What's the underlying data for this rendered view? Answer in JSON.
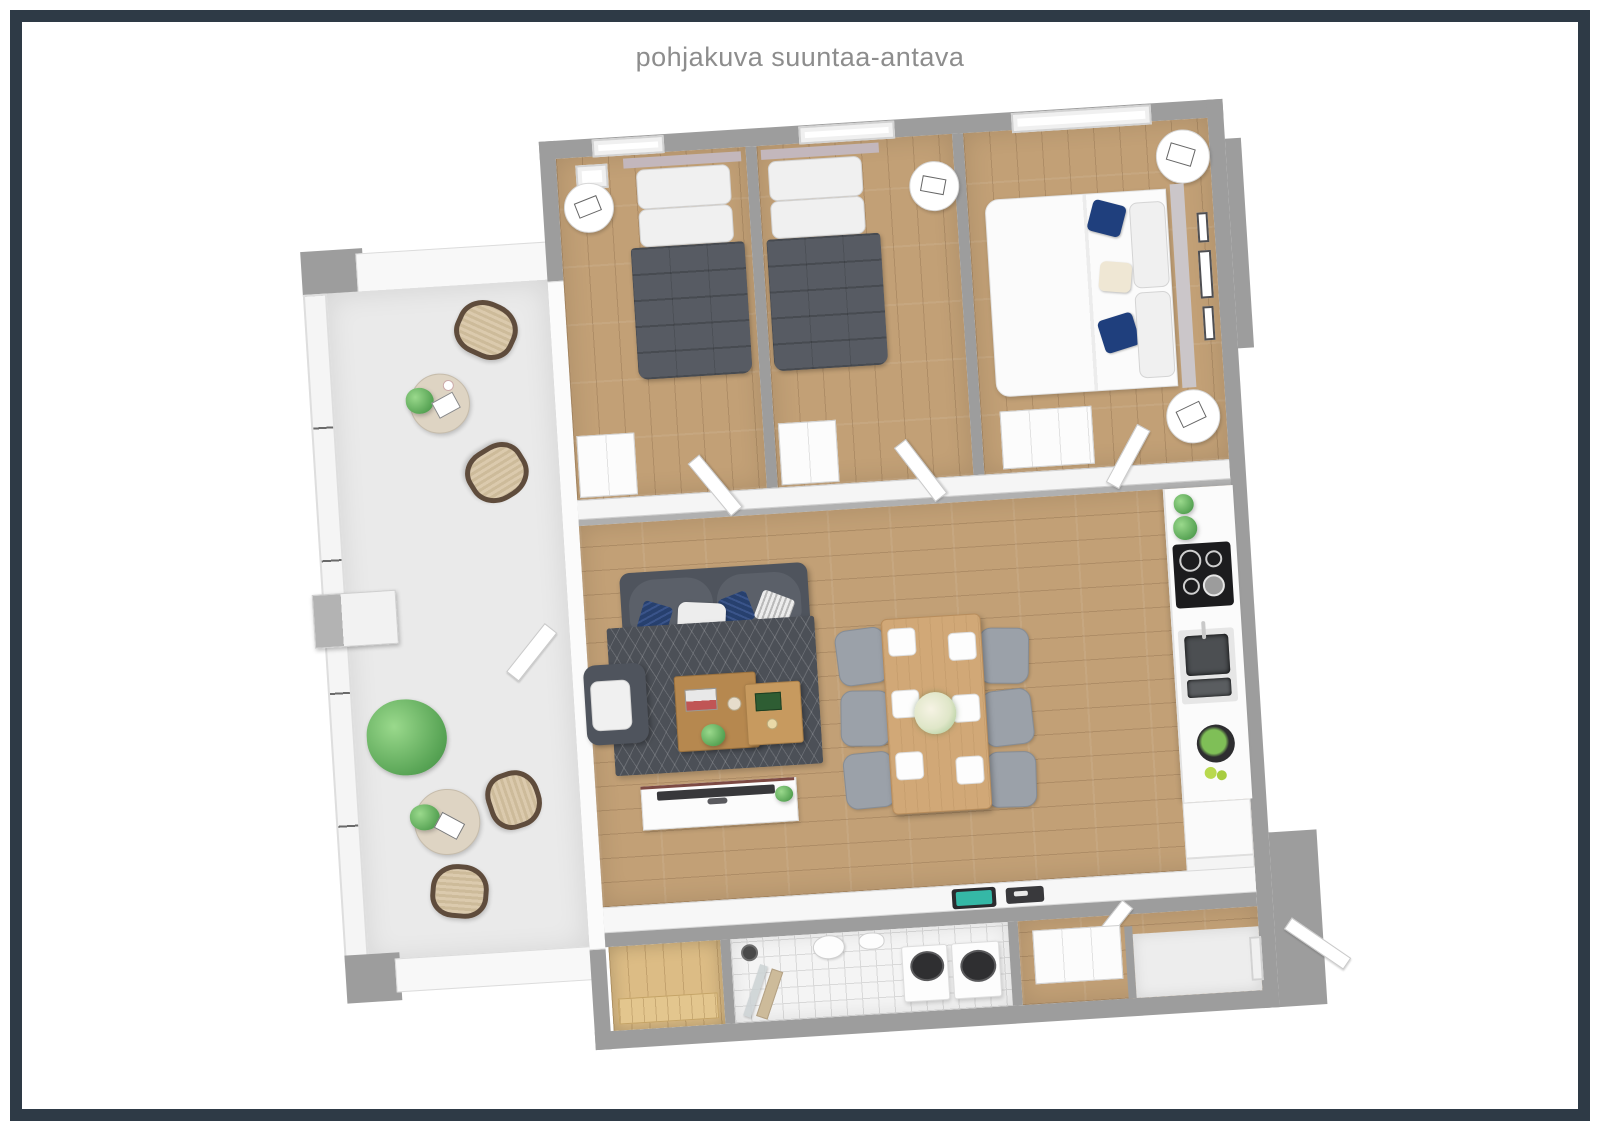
{
  "title": {
    "text": "pohjakuva suuntaa-antava"
  },
  "frame": {
    "border_color": "#2e3a46",
    "background": "#ffffff",
    "title_color": "#8d8d8d"
  },
  "palette": {
    "exterior_wall_gray": "#9d9d9d",
    "interior_wall_white": "#f8f8f8",
    "wood_floor": "#c2a076",
    "balcony_floor": "#eaeaea",
    "bathroom_tile": "#f4f4f4",
    "sauna_wood": "#dcbc85",
    "sofa_gray": "#4f545d",
    "duvet_dark_gray": "#575b63",
    "duvet_white": "#fbfbfb",
    "pillow_navy": "#1f3f7d",
    "rug_dark": "#4c5057",
    "coffee_table_wood": "#b6884f",
    "dining_table_wood": "#d1a877",
    "dining_chair_gray": "#9ba1a9",
    "plant_green": "#6fbf6a",
    "rattan_beige": "#d8c7a9",
    "cooktop_black": "#1c1c1e",
    "tablet_screen_teal": "#35b8a6"
  },
  "plan": {
    "name": "apartment-3d-floor-plan",
    "rooms": [
      {
        "id": "balcony"
      },
      {
        "id": "bedroom-1"
      },
      {
        "id": "bedroom-2"
      },
      {
        "id": "master-bedroom"
      },
      {
        "id": "living-room"
      },
      {
        "id": "dining-area"
      },
      {
        "id": "kitchen"
      },
      {
        "id": "sauna"
      },
      {
        "id": "bathroom"
      },
      {
        "id": "hallway"
      },
      {
        "id": "entry"
      }
    ],
    "furniture": [
      "single-bed",
      "single-bed",
      "double-bed",
      "nightstands",
      "wardrobes",
      "sofa",
      "armchair",
      "coffee-tables",
      "tv-stand",
      "rug",
      "dining-table",
      "dining-chairs",
      "cooktop",
      "kitchen-sink",
      "fruit-bowl",
      "washer-and-dryer",
      "shower",
      "toilet",
      "sauna-benches",
      "balcony-chairs",
      "balcony-tables",
      "plants",
      "entry-door"
    ]
  }
}
